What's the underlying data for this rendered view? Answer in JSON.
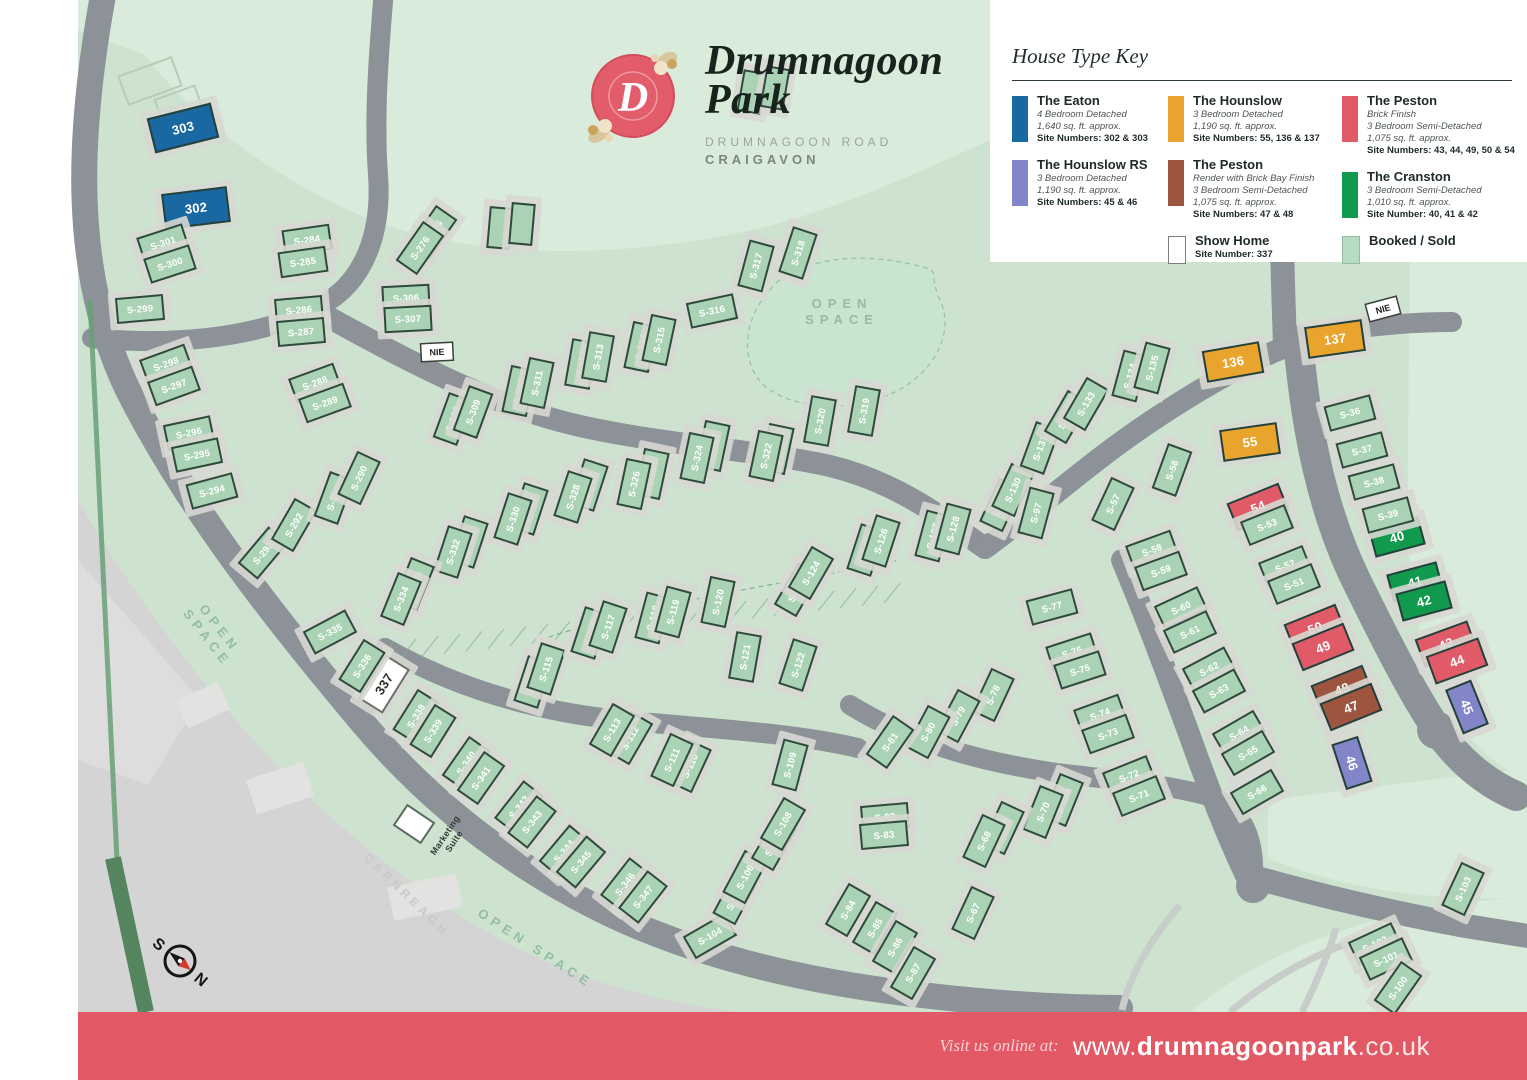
{
  "header": {
    "monogram": "D",
    "title_line1": "Drumnagoon",
    "title_line2": "Park",
    "address_line1": "DRUMNAGOON ROAD",
    "address_line2": "CRAIGAVON"
  },
  "legend": {
    "title": "House Type Key",
    "entries": {
      "eaton": {
        "name": "The Eaton",
        "details": [
          "4 Bedroom Detached",
          "1,640 sq. ft. approx."
        ],
        "sites": "Site Numbers: 302 & 303"
      },
      "hounslow": {
        "name": "The Hounslow",
        "details": [
          "3 Bedroom Detached",
          "1,190 sq. ft. approx."
        ],
        "sites": "Site Numbers: 55, 136 & 137"
      },
      "peston_brick": {
        "name": "The Peston",
        "details": [
          "Brick Finish",
          "3 Bedroom Semi-Detached",
          "1,075 sq. ft. approx."
        ],
        "sites": "Site Numbers: 43, 44, 49, 50 & 54"
      },
      "hounslow_rs": {
        "name": "The Hounslow RS",
        "details": [
          "3 Bedroom Detached",
          "1,190 sq. ft. approx."
        ],
        "sites": "Site Numbers: 45 & 46"
      },
      "peston_render": {
        "name": "The Peston",
        "details": [
          "Render with Brick Bay Finish",
          "3 Bedroom Semi-Detached",
          "1,075 sq. ft. approx."
        ],
        "sites": "Site Numbers: 47 & 48"
      },
      "cranston": {
        "name": "The Cranston",
        "details": [
          "3 Bedroom Semi-Detached",
          "1,010 sq. ft. approx."
        ],
        "sites": "Site Number: 40, 41 & 42"
      },
      "show_home": {
        "name": "Show Home",
        "details": [],
        "sites": "Site Number: 337"
      },
      "booked": {
        "name": "Booked / Sold",
        "details": [],
        "sites": ""
      }
    }
  },
  "colors": {
    "e": "#1a68a2",
    "h": "#e8a42c",
    "hr": "#8286c8",
    "pb": "#e05a68",
    "pr": "#9e5540",
    "c": "#119a4d",
    "sh": "#ffffff",
    "s": "#a9d3b4",
    "u": "#a9d3b4",
    "booked_swatch": "#b7dcc2",
    "banner": "#e25965",
    "road": "#8d9298",
    "map_bg": "#cde3d0"
  },
  "map": {
    "nie_label": "NIE",
    "compass": {
      "n": "N",
      "s": "S"
    },
    "labels": [
      {
        "t": "OPEN\nSPACE",
        "x": 842,
        "y": 316,
        "r": 0,
        "s": 13,
        "ls": 6,
        "c": "#93bda1"
      },
      {
        "t": "OPEN\nSPACE",
        "x": 210,
        "y": 636,
        "r": 52,
        "s": 13,
        "ls": 5,
        "c": "#93bda1"
      },
      {
        "t": "OPEN SPACE",
        "x": 533,
        "y": 952,
        "r": 33,
        "s": 13,
        "ls": 5,
        "c": "#93bda1"
      },
      {
        "t": "CARNREAGH",
        "x": 404,
        "y": 898,
        "r": 44,
        "s": 12,
        "ls": 4,
        "c": "#c6cac8"
      },
      {
        "t": "Marketing\nSuite",
        "x": 452,
        "y": 840,
        "r": -56,
        "s": 9,
        "ls": 0.3,
        "c": "#333b35"
      }
    ],
    "plots": [
      [
        "303",
        183,
        128,
        -14,
        "e"
      ],
      [
        "302",
        196,
        208,
        -7,
        "e"
      ],
      [
        "136",
        1233,
        362,
        -10,
        "h"
      ],
      [
        "137",
        1335,
        339,
        -8,
        "h"
      ],
      [
        "55",
        1250,
        442,
        -8,
        "h"
      ],
      [
        "54",
        1258,
        507,
        -22,
        "pb"
      ],
      [
        "50",
        1315,
        628,
        -22,
        "pb"
      ],
      [
        "49",
        1323,
        647,
        -22,
        "pb"
      ],
      [
        "43",
        1446,
        644,
        -20,
        "pb"
      ],
      [
        "44",
        1457,
        661,
        -20,
        "pb"
      ],
      [
        "48",
        1342,
        689,
        -22,
        "pr"
      ],
      [
        "47",
        1351,
        707,
        -22,
        "pr"
      ],
      [
        "40",
        1397,
        537,
        -15,
        "c"
      ],
      [
        "41",
        1415,
        582,
        -15,
        "c"
      ],
      [
        "42",
        1424,
        601,
        -15,
        "c"
      ],
      [
        "45",
        1467,
        707,
        68,
        "hr"
      ],
      [
        "46",
        1352,
        763,
        72,
        "hr"
      ],
      [
        "337",
        384,
        684,
        -58,
        "sh"
      ],
      [
        "S-301",
        163,
        243,
        -18
      ],
      [
        "S-300",
        170,
        264,
        -18
      ],
      [
        "S-299",
        140,
        309,
        -5
      ],
      [
        "S-298",
        166,
        364,
        -20
      ],
      [
        "S-297",
        174,
        386,
        -20
      ],
      [
        "S-296",
        189,
        433,
        -12
      ],
      [
        "S-295",
        197,
        455,
        -12
      ],
      [
        "S-294",
        212,
        491,
        -15
      ],
      [
        "S-293",
        263,
        553,
        -50
      ],
      [
        "S-292",
        294,
        525,
        -60
      ],
      [
        "S-291",
        334,
        498,
        -70
      ],
      [
        "S-290",
        359,
        478,
        -65
      ],
      [
        "S-284",
        307,
        240,
        -8
      ],
      [
        "S-285",
        303,
        262,
        -8
      ],
      [
        "S-286",
        299,
        310,
        -5
      ],
      [
        "S-287",
        301,
        332,
        -5
      ],
      [
        "S-288",
        315,
        383,
        -20
      ],
      [
        "S-289",
        325,
        403,
        -20
      ],
      [
        "S-275",
        433,
        232,
        -55
      ],
      [
        "S-276",
        420,
        248,
        -55
      ],
      [
        "S-306",
        406,
        298,
        -3
      ],
      [
        "S-307",
        408,
        319,
        -3
      ],
      [
        "S-308",
        453,
        419,
        -70
      ],
      [
        "S-309",
        473,
        412,
        -70
      ],
      [
        "S-310",
        519,
        391,
        -78
      ],
      [
        "S-311",
        537,
        383,
        -78
      ],
      [
        "S-312",
        581,
        364,
        -80
      ],
      [
        "S-313",
        598,
        357,
        -80
      ],
      [
        "S-314",
        641,
        347,
        -78
      ],
      [
        "S-315",
        659,
        340,
        -78
      ],
      [
        "S-316",
        712,
        311,
        -12
      ],
      [
        "S-317",
        756,
        266,
        -75
      ],
      [
        "S-318",
        798,
        253,
        -72
      ],
      [
        "S-319",
        864,
        411,
        -80
      ],
      [
        "S-320",
        820,
        421,
        -80
      ],
      [
        "S-321",
        777,
        449,
        -78
      ],
      [
        "S-322",
        766,
        456,
        -78
      ],
      [
        "S-323",
        713,
        446,
        -78
      ],
      [
        "S-324",
        697,
        458,
        -78
      ],
      [
        "S-325",
        652,
        474,
        -78
      ],
      [
        "S-326",
        634,
        484,
        -78
      ],
      [
        "S-327",
        589,
        485,
        -72
      ],
      [
        "S-328",
        573,
        497,
        -72
      ],
      [
        "S-329",
        529,
        509,
        -72
      ],
      [
        "S-330",
        513,
        519,
        -72
      ],
      [
        "S-331",
        469,
        542,
        -72
      ],
      [
        "S-332",
        453,
        552,
        -72
      ],
      [
        "S-333",
        414,
        584,
        -68
      ],
      [
        "S-334",
        401,
        599,
        -68
      ],
      [
        "S-335",
        330,
        632,
        -28
      ],
      [
        "S-336",
        362,
        666,
        -58
      ],
      [
        "S-338",
        416,
        716,
        -58
      ],
      [
        "S-339",
        433,
        731,
        -58
      ],
      [
        "S-340",
        466,
        763,
        -55
      ],
      [
        "S-341",
        481,
        778,
        -55
      ],
      [
        "S-342",
        519,
        807,
        -52
      ],
      [
        "S-343",
        532,
        822,
        -52
      ],
      [
        "S-344",
        564,
        851,
        -50
      ],
      [
        "S-345",
        581,
        862,
        -50
      ],
      [
        "S-346",
        625,
        884,
        -52
      ],
      [
        "S-347",
        643,
        897,
        -52
      ],
      [
        "S-104",
        710,
        936,
        -30
      ],
      [
        "S-105",
        735,
        898,
        -62
      ],
      [
        "S-106",
        745,
        877,
        -62
      ],
      [
        "S-107",
        774,
        844,
        -60
      ],
      [
        "S-108",
        783,
        824,
        -60
      ],
      [
        "S-109",
        790,
        765,
        -75
      ],
      [
        "S-110",
        690,
        766,
        -65
      ],
      [
        "S-111",
        672,
        760,
        -65
      ],
      [
        "S-112",
        630,
        738,
        -60
      ],
      [
        "S-113",
        612,
        730,
        -60
      ],
      [
        "S-114",
        533,
        682,
        -72
      ],
      [
        "S-115",
        546,
        669,
        -72
      ],
      [
        "S-116",
        590,
        633,
        -72
      ],
      [
        "S-117",
        608,
        627,
        -72
      ],
      [
        "S-118",
        653,
        618,
        -75
      ],
      [
        "S-119",
        673,
        612,
        -75
      ],
      [
        "S-120",
        718,
        602,
        -78
      ],
      [
        "S-121",
        745,
        657,
        -80
      ],
      [
        "S-122",
        798,
        665,
        -72
      ],
      [
        "S-123",
        797,
        590,
        -60
      ],
      [
        "S-124",
        811,
        573,
        -60
      ],
      [
        "S-125",
        866,
        550,
        -72
      ],
      [
        "S-126",
        881,
        541,
        -72
      ],
      [
        "S-127",
        933,
        536,
        -75
      ],
      [
        "S-128",
        953,
        529,
        -75
      ],
      [
        "S-129",
        1001,
        505,
        -65
      ],
      [
        "S-130",
        1013,
        490,
        -65
      ],
      [
        "S-131",
        1040,
        448,
        -70
      ],
      [
        "S-132",
        1067,
        417,
        -60
      ],
      [
        "S-133",
        1086,
        404,
        -60
      ],
      [
        "S-134",
        1130,
        376,
        -75
      ],
      [
        "S-135",
        1152,
        368,
        -75
      ],
      [
        "S-97",
        1036,
        513,
        -75
      ],
      [
        "S-56",
        1172,
        470,
        -70
      ],
      [
        "S-57",
        1113,
        504,
        -65
      ],
      [
        "S-58",
        1152,
        550,
        -20
      ],
      [
        "S-59",
        1161,
        571,
        -20
      ],
      [
        "S-60",
        1181,
        608,
        -25
      ],
      [
        "S-61",
        1190,
        632,
        -25
      ],
      [
        "S-62",
        1209,
        669,
        -28
      ],
      [
        "S-63",
        1219,
        691,
        -28
      ],
      [
        "S-64",
        1239,
        733,
        -30
      ],
      [
        "S-65",
        1248,
        753,
        -30
      ],
      [
        "S-66",
        1257,
        792,
        -30
      ],
      [
        "S-77",
        1052,
        607,
        -15
      ],
      [
        "S-76",
        1072,
        652,
        -18
      ],
      [
        "S-75",
        1080,
        670,
        -18
      ],
      [
        "S-74",
        1100,
        714,
        -20
      ],
      [
        "S-73",
        1108,
        734,
        -20
      ],
      [
        "S-72",
        1129,
        776,
        -22
      ],
      [
        "S-71",
        1139,
        796,
        -22
      ],
      [
        "S-70a",
        1063,
        800,
        -68
      ],
      [
        "S-70",
        1043,
        812,
        -68
      ],
      [
        "S-69",
        1003,
        828,
        -65
      ],
      [
        "S-68",
        984,
        841,
        -65
      ],
      [
        "S-67",
        973,
        913,
        -65
      ],
      [
        "S-78",
        993,
        695,
        -65
      ],
      [
        "S-79",
        958,
        716,
        -62
      ],
      [
        "S-80",
        928,
        732,
        -62
      ],
      [
        "S-81",
        890,
        742,
        -55
      ],
      [
        "S-82",
        885,
        817,
        -5
      ],
      [
        "S-83",
        884,
        835,
        -5
      ],
      [
        "S-84",
        848,
        910,
        -60
      ],
      [
        "S-85",
        875,
        928,
        -60
      ],
      [
        "S-86",
        895,
        947,
        -60
      ],
      [
        "S-87",
        913,
        973,
        -60
      ],
      [
        "S-36",
        1350,
        413,
        -15
      ],
      [
        "S-37",
        1362,
        450,
        -15
      ],
      [
        "S-38",
        1374,
        482,
        -15
      ],
      [
        "S-39",
        1388,
        515,
        -15
      ],
      [
        "S-53",
        1267,
        525,
        -22
      ],
      [
        "S-52",
        1285,
        566,
        -22
      ],
      [
        "S-51",
        1294,
        584,
        -22
      ],
      [
        "S-103",
        1463,
        889,
        -65
      ],
      [
        "S-102",
        1375,
        944,
        -25
      ],
      [
        "S-101",
        1386,
        959,
        -25
      ],
      [
        "S-100",
        1398,
        988,
        -55
      ],
      [
        "",
        500,
        228,
        -85,
        "u"
      ],
      [
        "",
        522,
        224,
        -85,
        "u"
      ],
      [
        "",
        752,
        92,
        -80,
        "u"
      ],
      [
        "",
        775,
        88,
        -80,
        "u"
      ]
    ]
  },
  "footer": {
    "prefix": "Visit us online at:",
    "www": "www.",
    "domain": "drumnagoonpark",
    "tld": ".co.uk"
  }
}
